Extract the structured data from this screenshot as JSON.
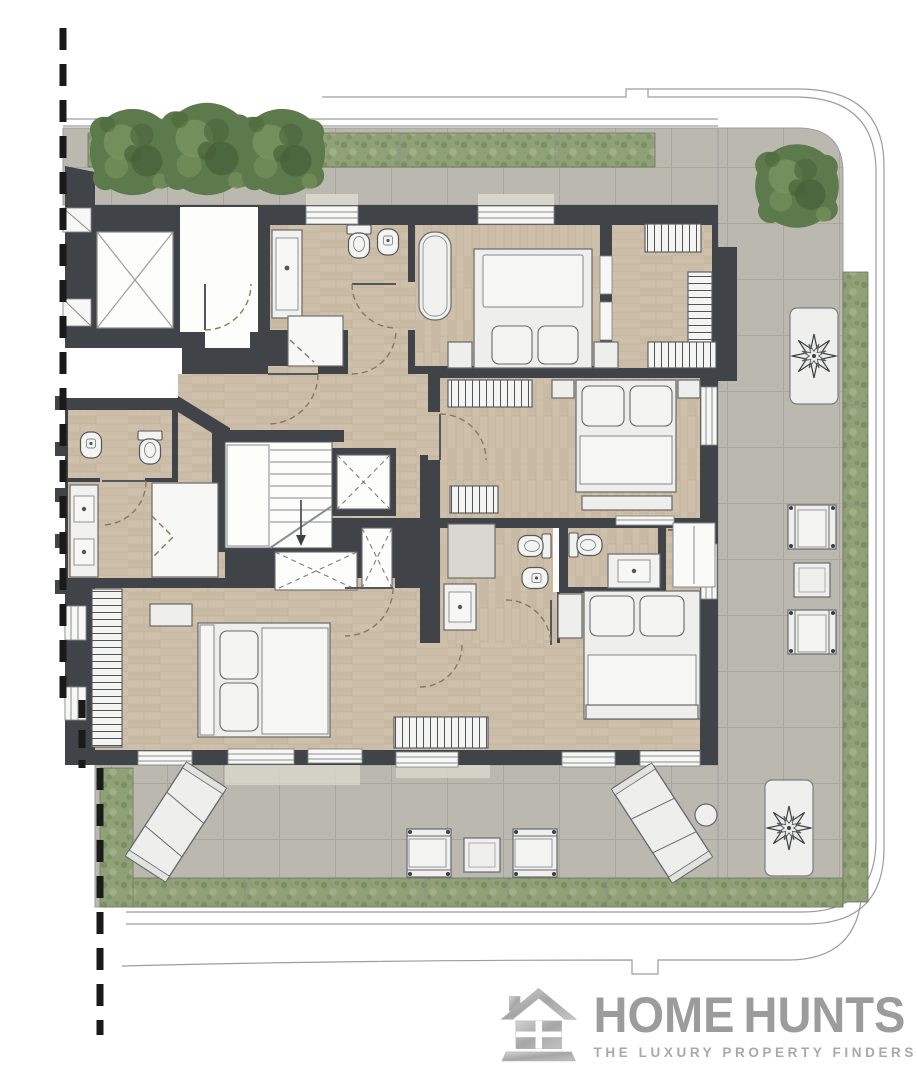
{
  "logo": {
    "brand_part1": "HOME",
    "brand_part2": "HUNTS",
    "tagline": "THE LUXURY PROPERTY FINDERS"
  },
  "palette": {
    "wall": "#404347",
    "wood": "#cec0ab",
    "wood2": "#c0af98",
    "wood3": "#b0a089",
    "terrace": "#bab8af",
    "tileline": "#a8a69b",
    "hedge": "#90a178",
    "hedgeDark": "#6f8a55",
    "hedgeLight": "#a7b68d",
    "tree": "#5c7a4b",
    "treeDark": "#476339",
    "treeLight": "#79955f",
    "fixture": "#f1f1ef",
    "outline": "#66696c",
    "door": "#8c7660",
    "boundary": "#9d9d9d",
    "dashline": "#1a1a1a",
    "mat": "#d8d5cb",
    "showerTray": "#d9d7d1",
    "logoGray": "#9c9c9c",
    "logoLight": "#a9a9a9"
  },
  "plan": {
    "type": "apartment-floor-plan",
    "depicted_elements": [
      "property-boundary-dashed-line",
      "wrap-around-terrace-with-pavers",
      "hedge-planters",
      "trees",
      "elevator",
      "staircase",
      "bedroom-top",
      "bedroom-middle-right",
      "bedroom-bottom-left",
      "bedroom-bottom-right",
      "bathroom-top",
      "bathroom-left",
      "wc-left",
      "bathroom-center-1",
      "bathroom-center-2",
      "walk-in-closet",
      "bathtub",
      "showers",
      "sun-loungers",
      "outdoor-armchairs-and-tables",
      "potted-star-plants"
    ]
  }
}
